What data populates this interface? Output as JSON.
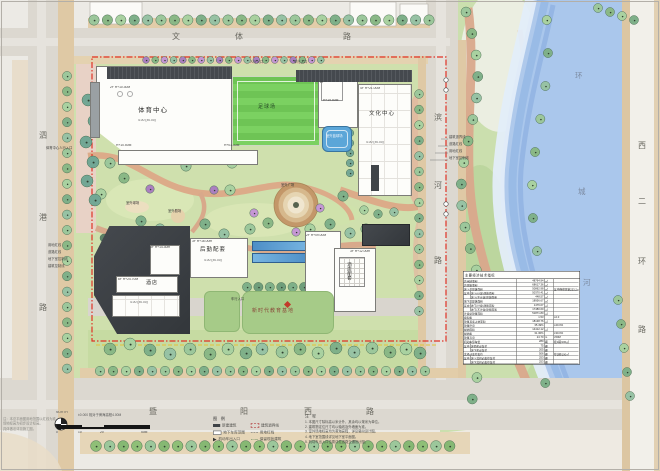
{
  "roads": {
    "top": [
      "文",
      "体",
      "路"
    ],
    "left": [
      "泗",
      "港",
      "路"
    ],
    "bottom": [
      "暨",
      "阳",
      "西",
      "路"
    ],
    "mid": [
      "滨",
      "河",
      "路"
    ],
    "right": [
      "西",
      "二",
      "环",
      "路"
    ],
    "river": [
      "环",
      "城",
      "河"
    ]
  },
  "buildings": {
    "sports": "体育中心",
    "culture": "文化中心",
    "logistics": "后勤配套",
    "hotel": "酒店",
    "hotel_support": "酒店配套",
    "education": "新时代教育基地"
  },
  "spaces": {
    "field": "足球场",
    "court": "室外篮球场",
    "plaza": "室外广场",
    "theater": "室外剧场",
    "courts2": "室外球场"
  },
  "entrances": [
    "人行入口",
    "车行入口",
    "体育中心人行入口"
  ],
  "height_labels": [
    "2F H+10.30M",
    "H+10.50M",
    "H+01.30M",
    "2F",
    "H+19.50M",
    "4F H+21.00M",
    "3F H+16.00m",
    "3F H+14.30m",
    "6F H+24.70M",
    "3F H+12.00m",
    "2F H+09.00M"
  ],
  "elev_label": "4.00 (±0.00)",
  "annotations": {
    "left": [
      "用地红线",
      "道路红线",
      "地下室控制线",
      "建筑控制线"
    ],
    "right": [
      "建筑退界线",
      "道路红线",
      "用地红线",
      "地下室控制线"
    ]
  },
  "scalebar": {
    "north": "NORTH",
    "datum": "±0.000 相对于黄海高程4.00M",
    "ticks": [
      "0",
      "10",
      "20",
      "50M"
    ]
  },
  "legend": {
    "title": "图 例",
    "left": [
      {
        "sym": "solid",
        "label": "新建建筑"
      },
      {
        "sym": "outline",
        "label": "地下车库范围"
      },
      {
        "sym": "arrow",
        "label": "机动车出入口"
      }
    ],
    "right": [
      {
        "sym": "corner",
        "label": "建筑退界线"
      },
      {
        "sym": "dash",
        "label": "用地红线"
      },
      {
        "sym": "wave",
        "label": "保留现状建筑"
      }
    ]
  },
  "notes": {
    "title": "注 释",
    "lines": [
      "1. 本图尺寸除标高以米计外，其余均以毫米为单位。",
      "2. 建筑物定位尺寸均以轴线及外墙面为准。",
      "3. 室外场地标高均为黄海高程，详见竖向设计图。",
      "4. 地下室范围线详见地下室平面图。",
      "5. 机动车出入口位置详见道路交通设计图。"
    ]
  },
  "notes_left": [
    "注：本总平面图用地范围以红线为准。",
    "场地标高为初步设计标高。",
    "具体做法详见施工图。"
  ],
  "table": {
    "title": "主要经济技术指标",
    "rows": [
      [
        "",
        "总用地面积",
        "48764.94",
        "㎡",
        ""
      ],
      [
        "",
        "总建筑面积",
        "68617.36",
        "㎡",
        ""
      ],
      [
        "",
        "地上总建筑面积",
        "50862.98",
        "㎡",
        "其中保留建筑233.2㎡"
      ],
      [
        "其中",
        "地上(计容)建筑面积",
        "50370.41",
        "㎡",
        ""
      ],
      [
        "",
        "地上(不计容)建筑面积",
        "448.57",
        "㎡",
        ""
      ],
      [
        "",
        "地下总建筑面积",
        "18956.67",
        "㎡",
        ""
      ],
      [
        "其中",
        "地下(计容)建筑面积",
        "1476.07",
        "㎡",
        ""
      ],
      [
        "",
        "地下(不计容)建筑面积",
        "17480.60",
        "㎡",
        ""
      ],
      [
        "",
        "计容总建筑面积",
        "51871.80",
        "㎡",
        ""
      ],
      [
        "",
        "容积率",
        "1.53",
        "",
        "≤2.0"
      ],
      [
        "",
        "建筑基底占地面积",
        "18138.76",
        "㎡",
        ""
      ],
      [
        "",
        "建筑密度",
        "35.49%",
        "",
        "≤40.0%"
      ],
      [
        "",
        "绿地面积",
        "14412.12",
        "㎡",
        ""
      ],
      [
        "",
        "绿地率",
        "31.30%",
        "",
        "≥30.0%"
      ],
      [
        "",
        "建筑高度",
        "24.70",
        "m",
        "≤50M"
      ],
      [
        "",
        "机动车停车位",
        "280",
        "辆",
        "按1辆/100㎡"
      ],
      [
        "其中",
        "地面机动车位",
        "75",
        "辆",
        ""
      ],
      [
        "",
        "地下机动车位",
        "205",
        "辆",
        ""
      ],
      [
        "",
        "非机动车停车位",
        "506",
        "辆",
        "按2辆/100㎡"
      ],
      [
        "其中",
        "地上非机动车停车位",
        "253",
        "辆",
        ""
      ],
      [
        "",
        "地下非机动车停车位",
        "253",
        "辆",
        ""
      ]
    ]
  }
}
